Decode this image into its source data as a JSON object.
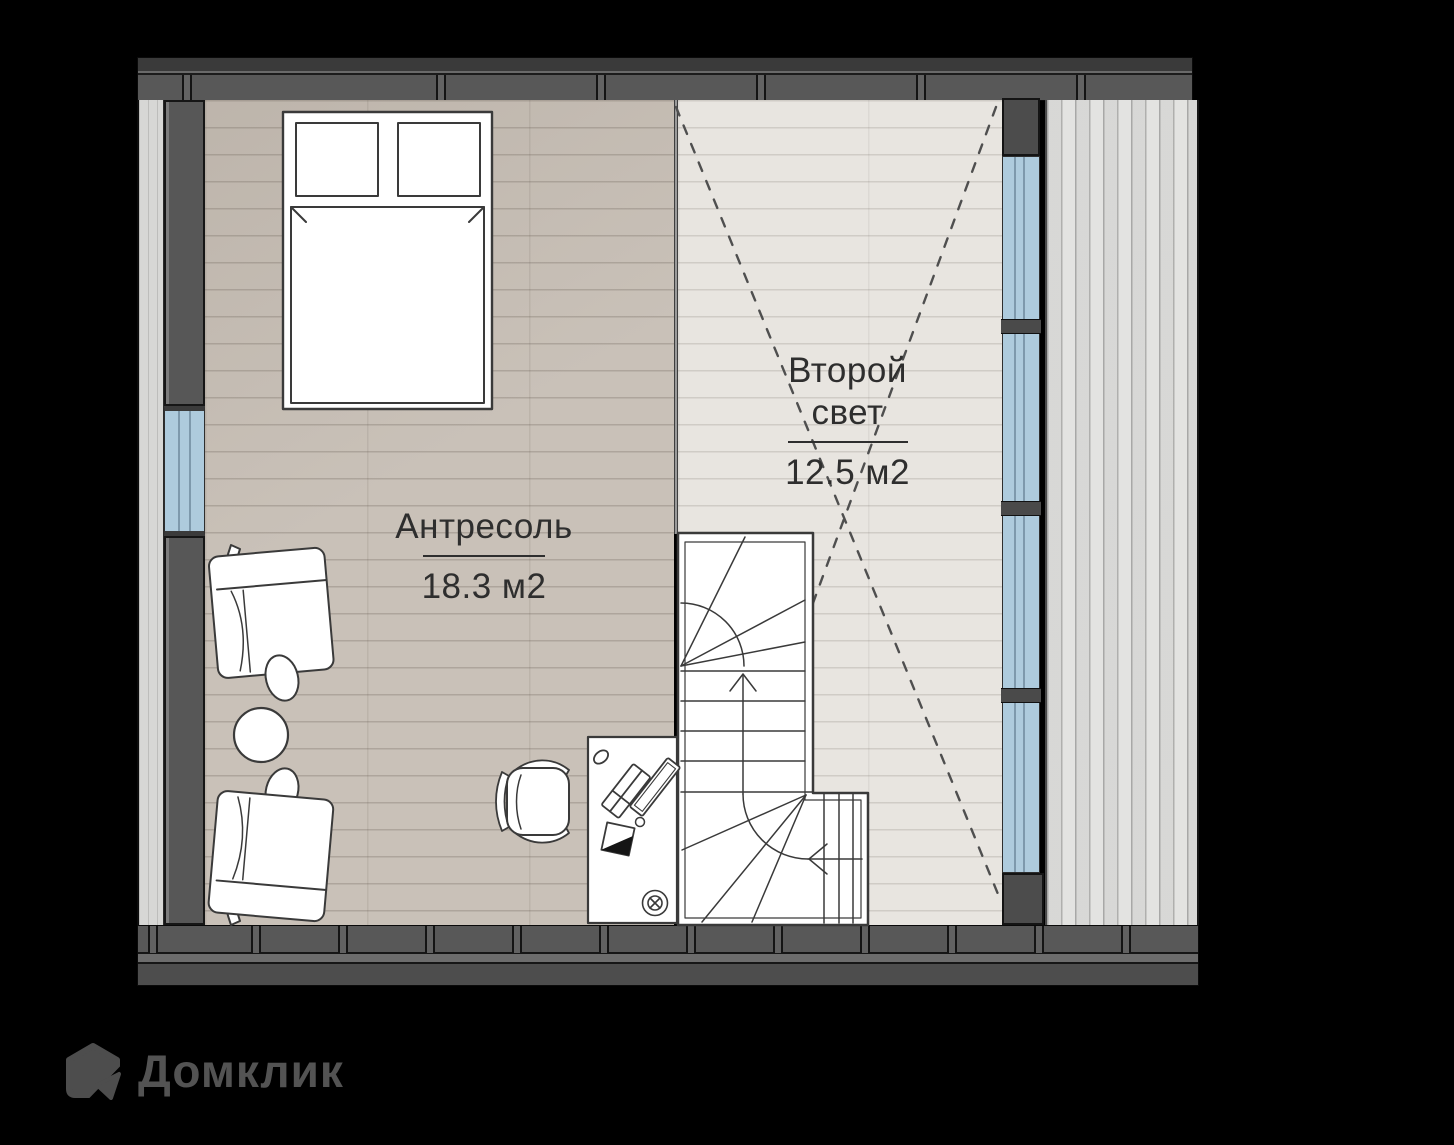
{
  "plan": {
    "rooms": [
      {
        "name": "Антресоль",
        "area": "18.3 м2"
      },
      {
        "name": "Второй свет",
        "area": "12.5 м2"
      }
    ]
  },
  "branding": {
    "logo_text": "Домклик"
  },
  "icons": {
    "logo": "domclick-house-icon"
  },
  "colors": {
    "background": "#000000",
    "wall": "#565656",
    "window_glass": "#aecbdd",
    "floor_mezzanine": "#c9c1b8",
    "floor_second_light": "#e8e5e0",
    "deck": "#e3e3e1",
    "furniture_fill": "#ffffff",
    "drawing_line": "#3a3a3a",
    "logo_gray": "#4f4f4f"
  }
}
